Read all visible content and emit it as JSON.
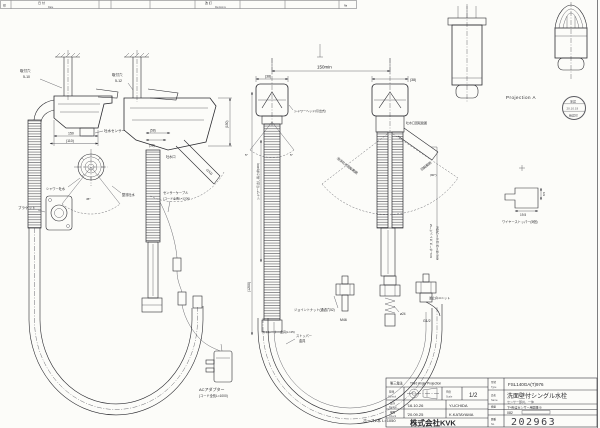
{
  "revision": {
    "stamp": "印",
    "date_jp": "日 付",
    "date_en": "Date",
    "rev_jp": "改 訂",
    "rev_en": "Revisions",
    "no": "№"
  },
  "dims": {
    "d150min": "150min",
    "d38L": "(38)",
    "d38R": "(38)",
    "d150": "150",
    "d110": "(110)",
    "d58": "(58)",
    "d38b": "(38)",
    "d152": "(152)",
    "d150v": "(150)",
    "d1200": "(1200)",
    "pull": "シャワー引出し長さ(約300)",
    "deg5L": "5°",
    "deg5R": "5°",
    "deg45": "45°",
    "deg90": "(90°)",
    "d195": "19.5",
    "d85": "8.5"
  },
  "view1": {
    "hole1": "取付穴",
    "hole2": "5-10",
    "sensor": "吐水センサー",
    "shower": "シャワー吐水",
    "stream": "整流吐水",
    "bracket": "ブラケット"
  },
  "view2": {
    "hole1": "取付穴",
    "hole2": "5-12",
    "spout": "吐水口",
    "cable1": "センサーケーブル",
    "cable2": "(コード全長L=1200)",
    "strainer": "ストレーナー金具(L=45)"
  },
  "front": {
    "head": "シャワーヘッド(引出式)",
    "rot": "吐水口回転範囲",
    "spray": "泡沫吐水回転範囲",
    "rot2": "回転範囲",
    "joint": "ジョイントナット(通過穴52)",
    "m46": "M46",
    "dia24": "ø24",
    "g12": "G1/2",
    "check": "逆止弁ユニット",
    "stopper1": "ストッパー",
    "stopper2": "金具",
    "adapter1": "ACアダプター",
    "adapter2": "(コード全長L=1000)",
    "hose2": "ホース2本 L=1050"
  },
  "right": {
    "projection": "Projection A",
    "stamp1": "承認",
    "stamp2": "20.10.19",
    "stamp3": "確認印",
    "part1": "KVL-ホース ストッパーM",
    "part2": "KVL-ホース スリーブ付M",
    "wire": "ワイヤーストッパー(5個)"
  },
  "titleblock": {
    "projection_jp": "第三角法",
    "projection_en": "Third Angle Projection",
    "control_jp": "管理",
    "control_en": "Control",
    "scale_jp": "尺度",
    "scale_en": "Scale",
    "scale_value": "1/2",
    "design_jp": "設計",
    "design_en": "Design",
    "design_date": "'16.10.26",
    "design_name": "Y.UCHIDA",
    "check_jp": "検図",
    "check_en": "Check",
    "check_date": "'20.09.25",
    "check_name": "K.KATAYAMA",
    "company": "株式会社KVK",
    "model_label_jp": "型式",
    "model_label_en": "Type",
    "model": "FSL140GA(T)976",
    "name_label_jp": "品名",
    "name_label_en": "Name",
    "product": "洗面壁付シングル水栓",
    "product_sub": "センサー部共、一体",
    "note_label_jp": "摘要",
    "note_label_en": "Note",
    "note": "下4桁はセンサー用図番 B",
    "note_sub": "082",
    "no_label_jp": "図番",
    "no_label_en": "No.",
    "number": "202963"
  }
}
